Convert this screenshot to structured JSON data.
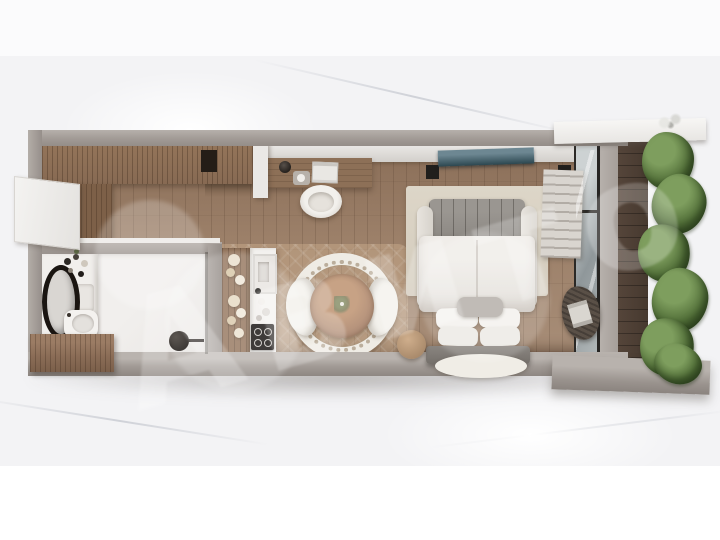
{
  "meta": {
    "title": "Studio apartment 3D floor plan render",
    "description": "Top-down 3D render of a studio apartment: bathroom with oval mirror and vanity, wardrobe, desk with chair, kitchen counter with sink and cooktop, round rattan dining set, double bed with tufted headboard facing a wall TV, and a balcony with a vertical plant wall, all on a white marble background",
    "watermark": "Авито"
  },
  "rooms": [
    {
      "name": "bathroom"
    },
    {
      "name": "kitchen"
    },
    {
      "name": "dining area"
    },
    {
      "name": "bedroom"
    },
    {
      "name": "balcony"
    },
    {
      "name": "wardrobe and desk area"
    }
  ],
  "colors": {
    "marble": "#f3f3f5",
    "wall": "#a19a95",
    "wallLight": "#b6b0ab",
    "floorWood": "#9c8069",
    "wardrobeWood": "#8b6d56",
    "cabinetWood": "#8a6c56",
    "counterWhite": "#f3f1ee",
    "cooktopBlack": "#14110f",
    "tableWood": "#b2907a",
    "chairWhite": "#f2f0eb",
    "duvetWhite": "#eae7e2",
    "headboardGray": "#908c87",
    "rugBeige": "#d8d1c2",
    "tvScreen": "#31505a",
    "plantGreen": "#4f6b38",
    "balconyWood": "#4c3e33",
    "glassGray": "#9aa1a4",
    "mirrorFrame": "#1a1511",
    "watermarkColor": "rgba(255,255,255,0.22)"
  }
}
